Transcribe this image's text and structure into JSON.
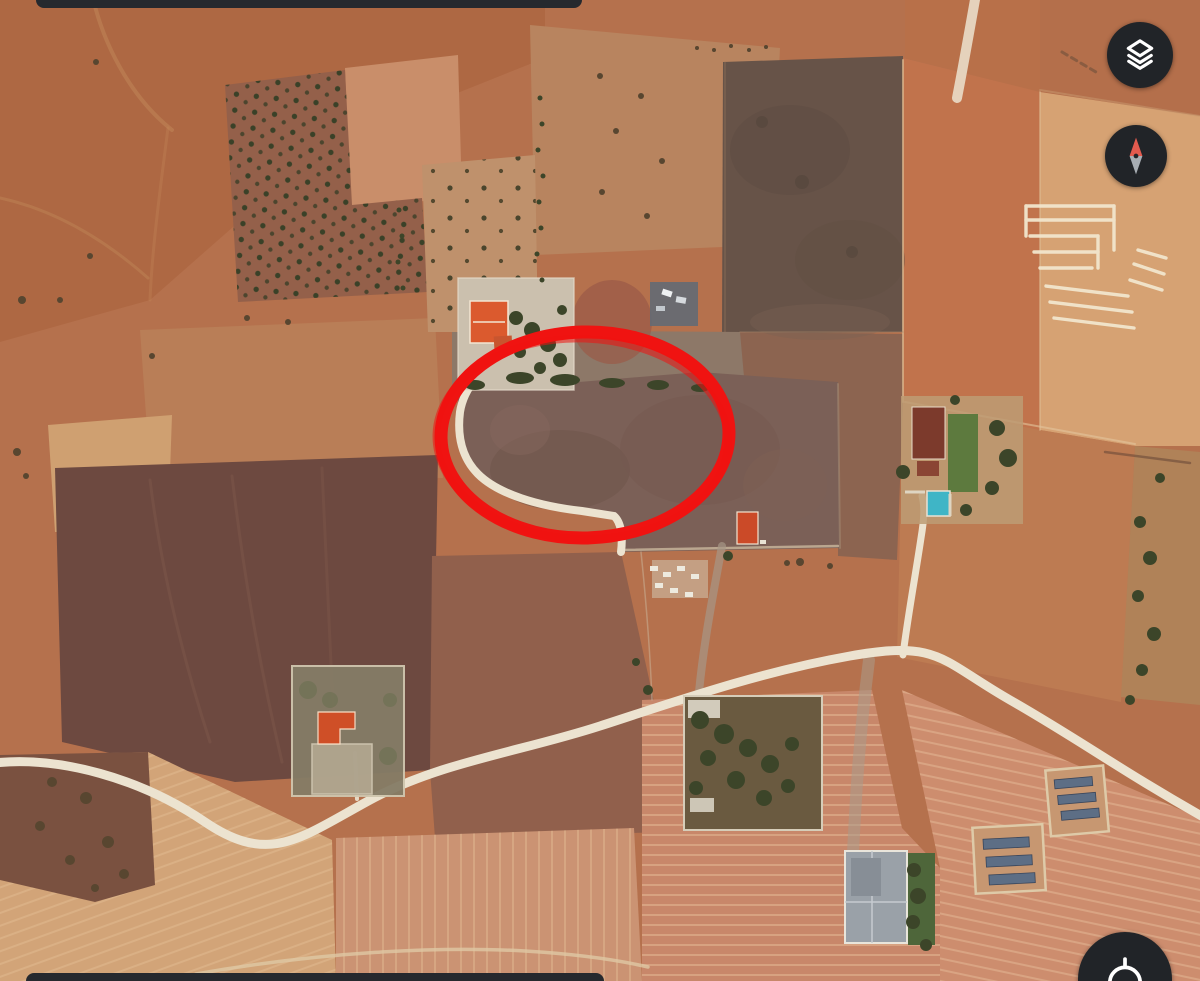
{
  "view": {
    "kind": "satellite-map-screenshot"
  },
  "annotation": {
    "shape": "hand-drawn-ellipse",
    "purpose": "highlighted-land-parcel",
    "color": "#f01311"
  },
  "controls": {
    "layers": {
      "icon": "layers-icon",
      "aria_label": "Map layers"
    },
    "compass": {
      "icon": "compass-icon",
      "aria_label": "Compass"
    },
    "locate": {
      "icon": "my-location-icon",
      "aria_label": "My location"
    }
  },
  "system_bars": {
    "top_fragment": true,
    "bottom_fragment": true
  },
  "palette": {
    "land-base": "#b5714d",
    "road-white": "#ece3d0",
    "annotation-red": "#f01311",
    "control-bg": "#212428",
    "control-icon": "#ffffff",
    "needle-red": "#e25a4e",
    "needle-gray": "#a7adb3",
    "system-bar": "#26292e"
  }
}
